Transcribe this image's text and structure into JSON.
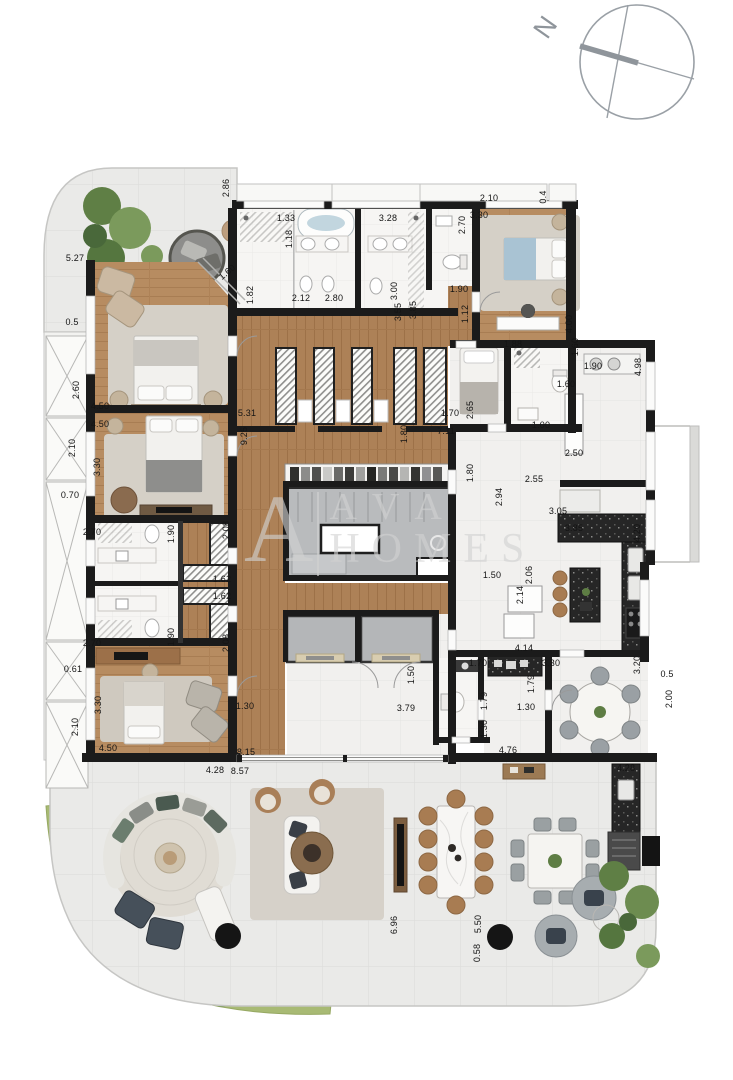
{
  "compass": {
    "north_label": "N"
  },
  "watermark": {
    "monogram": "A",
    "line1": "AVA",
    "line2": "HOMES"
  },
  "palette": {
    "wall": "#1b1b1b",
    "wood": "#b78c61",
    "wood_dark": "#ad8157",
    "terrace_tile": "#eaeae8",
    "interior_tile": "#f1f0ee",
    "marble": "#f6f5f3",
    "granite": "#262626",
    "core_gray": "#b9bbbd",
    "rug": "#d5d0c7",
    "grass": "#a8ba74",
    "plant_green": "#5f7f45",
    "bed_blue": "#a9c3d3",
    "dimension_text": "#141414",
    "compass_gray": "#8f959b",
    "watermark_gray": "#d2d2d2"
  },
  "dimensions": [
    {
      "text": "2.86",
      "x": 226,
      "y": 188,
      "rot": -90
    },
    {
      "text": "2.10",
      "x": 489,
      "y": 198,
      "rot": 0
    },
    {
      "text": "0.4",
      "x": 543,
      "y": 197,
      "rot": -90
    },
    {
      "text": "5.27",
      "x": 75,
      "y": 258,
      "rot": 0
    },
    {
      "text": "1.33",
      "x": 286,
      "y": 218,
      "rot": 0
    },
    {
      "text": "1.18",
      "x": 289,
      "y": 239,
      "rot": -90
    },
    {
      "text": "3.28",
      "x": 388,
      "y": 218,
      "rot": 0
    },
    {
      "text": "2.70",
      "x": 462,
      "y": 225,
      "rot": -90
    },
    {
      "text": "3.30",
      "x": 479,
      "y": 215,
      "rot": 0
    },
    {
      "text": "0.5",
      "x": 72,
      "y": 322,
      "rot": 0
    },
    {
      "text": "1.60",
      "x": 227,
      "y": 272,
      "rot": -40
    },
    {
      "text": "1.82",
      "x": 250,
      "y": 295,
      "rot": -90
    },
    {
      "text": "2.12",
      "x": 301,
      "y": 298,
      "rot": 0
    },
    {
      "text": "2.80",
      "x": 334,
      "y": 298,
      "rot": 0
    },
    {
      "text": "3.00",
      "x": 394,
      "y": 291,
      "rot": -90
    },
    {
      "text": "1.90",
      "x": 459,
      "y": 289,
      "rot": 0
    },
    {
      "text": "3.55",
      "x": 398,
      "y": 312,
      "rot": -90
    },
    {
      "text": "3.85",
      "x": 413,
      "y": 310,
      "rot": -90
    },
    {
      "text": "1.12",
      "x": 465,
      "y": 314,
      "rot": -90
    },
    {
      "text": "4.00",
      "x": 569,
      "y": 324,
      "rot": -90
    },
    {
      "text": "1.88",
      "x": 513,
      "y": 344,
      "rot": 0
    },
    {
      "text": "1.60",
      "x": 575,
      "y": 347,
      "rot": -90
    },
    {
      "text": "1.60",
      "x": 566,
      "y": 384,
      "rot": 0
    },
    {
      "text": "1.90",
      "x": 593,
      "y": 366,
      "rot": 0
    },
    {
      "text": "4.98",
      "x": 638,
      "y": 367,
      "rot": -90
    },
    {
      "text": "2.60",
      "x": 76,
      "y": 390,
      "rot": -90
    },
    {
      "text": "4.50",
      "x": 100,
      "y": 406,
      "rot": 0
    },
    {
      "text": "4.50",
      "x": 100,
      "y": 424,
      "rot": 0
    },
    {
      "text": "3.30",
      "x": 97,
      "y": 467,
      "rot": -90
    },
    {
      "text": "2.10",
      "x": 72,
      "y": 448,
      "rot": -90
    },
    {
      "text": "0.70",
      "x": 70,
      "y": 495,
      "rot": 0
    },
    {
      "text": "5.31",
      "x": 247,
      "y": 413,
      "rot": 0
    },
    {
      "text": "9.25",
      "x": 244,
      "y": 436,
      "rot": -90
    },
    {
      "text": "1.70",
      "x": 450,
      "y": 413,
      "rot": 0
    },
    {
      "text": "2.65",
      "x": 470,
      "y": 410,
      "rot": -90
    },
    {
      "text": "7.11",
      "x": 446,
      "y": 431,
      "rot": 0
    },
    {
      "text": "1.80",
      "x": 404,
      "y": 434,
      "rot": -90
    },
    {
      "text": "1.80",
      "x": 470,
      "y": 473,
      "rot": -90
    },
    {
      "text": "1.00",
      "x": 541,
      "y": 425,
      "rot": 0
    },
    {
      "text": "2.50",
      "x": 574,
      "y": 453,
      "rot": 0
    },
    {
      "text": "2.55",
      "x": 534,
      "y": 479,
      "rot": 0
    },
    {
      "text": "2.94",
      "x": 499,
      "y": 497,
      "rot": -90
    },
    {
      "text": "3.05",
      "x": 558,
      "y": 511,
      "rot": 0
    },
    {
      "text": "3.85",
      "x": 574,
      "y": 528,
      "rot": 0
    },
    {
      "text": "4.20",
      "x": 637,
      "y": 533,
      "rot": -90
    },
    {
      "text": "1.50",
      "x": 492,
      "y": 575,
      "rot": 0
    },
    {
      "text": "2.06",
      "x": 529,
      "y": 575,
      "rot": -90
    },
    {
      "text": "2.14",
      "x": 520,
      "y": 595,
      "rot": -90
    },
    {
      "text": "4.14",
      "x": 524,
      "y": 648,
      "rot": 0
    },
    {
      "text": "3.30",
      "x": 551,
      "y": 663,
      "rot": 0
    },
    {
      "text": "3.20",
      "x": 637,
      "y": 665,
      "rot": -90
    },
    {
      "text": "0.5",
      "x": 667,
      "y": 674,
      "rot": 0
    },
    {
      "text": "2.00",
      "x": 669,
      "y": 699,
      "rot": -90
    },
    {
      "text": "1.70",
      "x": 478,
      "y": 663,
      "rot": 0
    },
    {
      "text": "1.79",
      "x": 484,
      "y": 701,
      "rot": -90
    },
    {
      "text": "1.30",
      "x": 484,
      "y": 729,
      "rot": -90
    },
    {
      "text": "1.79",
      "x": 531,
      "y": 684,
      "rot": -90
    },
    {
      "text": "1.30",
      "x": 526,
      "y": 707,
      "rot": 0
    },
    {
      "text": "2.70",
      "x": 92,
      "y": 532,
      "rot": 0
    },
    {
      "text": "1.90",
      "x": 171,
      "y": 534,
      "rot": -90
    },
    {
      "text": "2.08",
      "x": 226,
      "y": 530,
      "rot": -90
    },
    {
      "text": "1.62",
      "x": 222,
      "y": 579,
      "rot": 0
    },
    {
      "text": "1.62",
      "x": 222,
      "y": 596,
      "rot": 0
    },
    {
      "text": "2.08",
      "x": 226,
      "y": 643,
      "rot": -90
    },
    {
      "text": "2.70",
      "x": 92,
      "y": 643,
      "rot": 0
    },
    {
      "text": "1.90",
      "x": 171,
      "y": 637,
      "rot": -90
    },
    {
      "text": "0.61",
      "x": 73,
      "y": 669,
      "rot": 0
    },
    {
      "text": "3.30",
      "x": 98,
      "y": 705,
      "rot": -90
    },
    {
      "text": "2.10",
      "x": 75,
      "y": 727,
      "rot": -90
    },
    {
      "text": "4.50",
      "x": 108,
      "y": 748,
      "rot": 0
    },
    {
      "text": "1.30",
      "x": 245,
      "y": 706,
      "rot": 0
    },
    {
      "text": "1.50",
      "x": 411,
      "y": 675,
      "rot": -90
    },
    {
      "text": "3.79",
      "x": 406,
      "y": 708,
      "rot": 0
    },
    {
      "text": "8.15",
      "x": 246,
      "y": 752,
      "rot": 0
    },
    {
      "text": "8.57",
      "x": 240,
      "y": 771,
      "rot": 0
    },
    {
      "text": "4.28",
      "x": 215,
      "y": 770,
      "rot": 0
    },
    {
      "text": "4.76",
      "x": 508,
      "y": 750,
      "rot": 0
    },
    {
      "text": "4.28",
      "x": 626,
      "y": 768,
      "rot": 0
    },
    {
      "text": "6.96",
      "x": 394,
      "y": 925,
      "rot": -90
    },
    {
      "text": "5.50",
      "x": 478,
      "y": 924,
      "rot": -90
    },
    {
      "text": "0.58",
      "x": 477,
      "y": 953,
      "rot": -90
    }
  ]
}
